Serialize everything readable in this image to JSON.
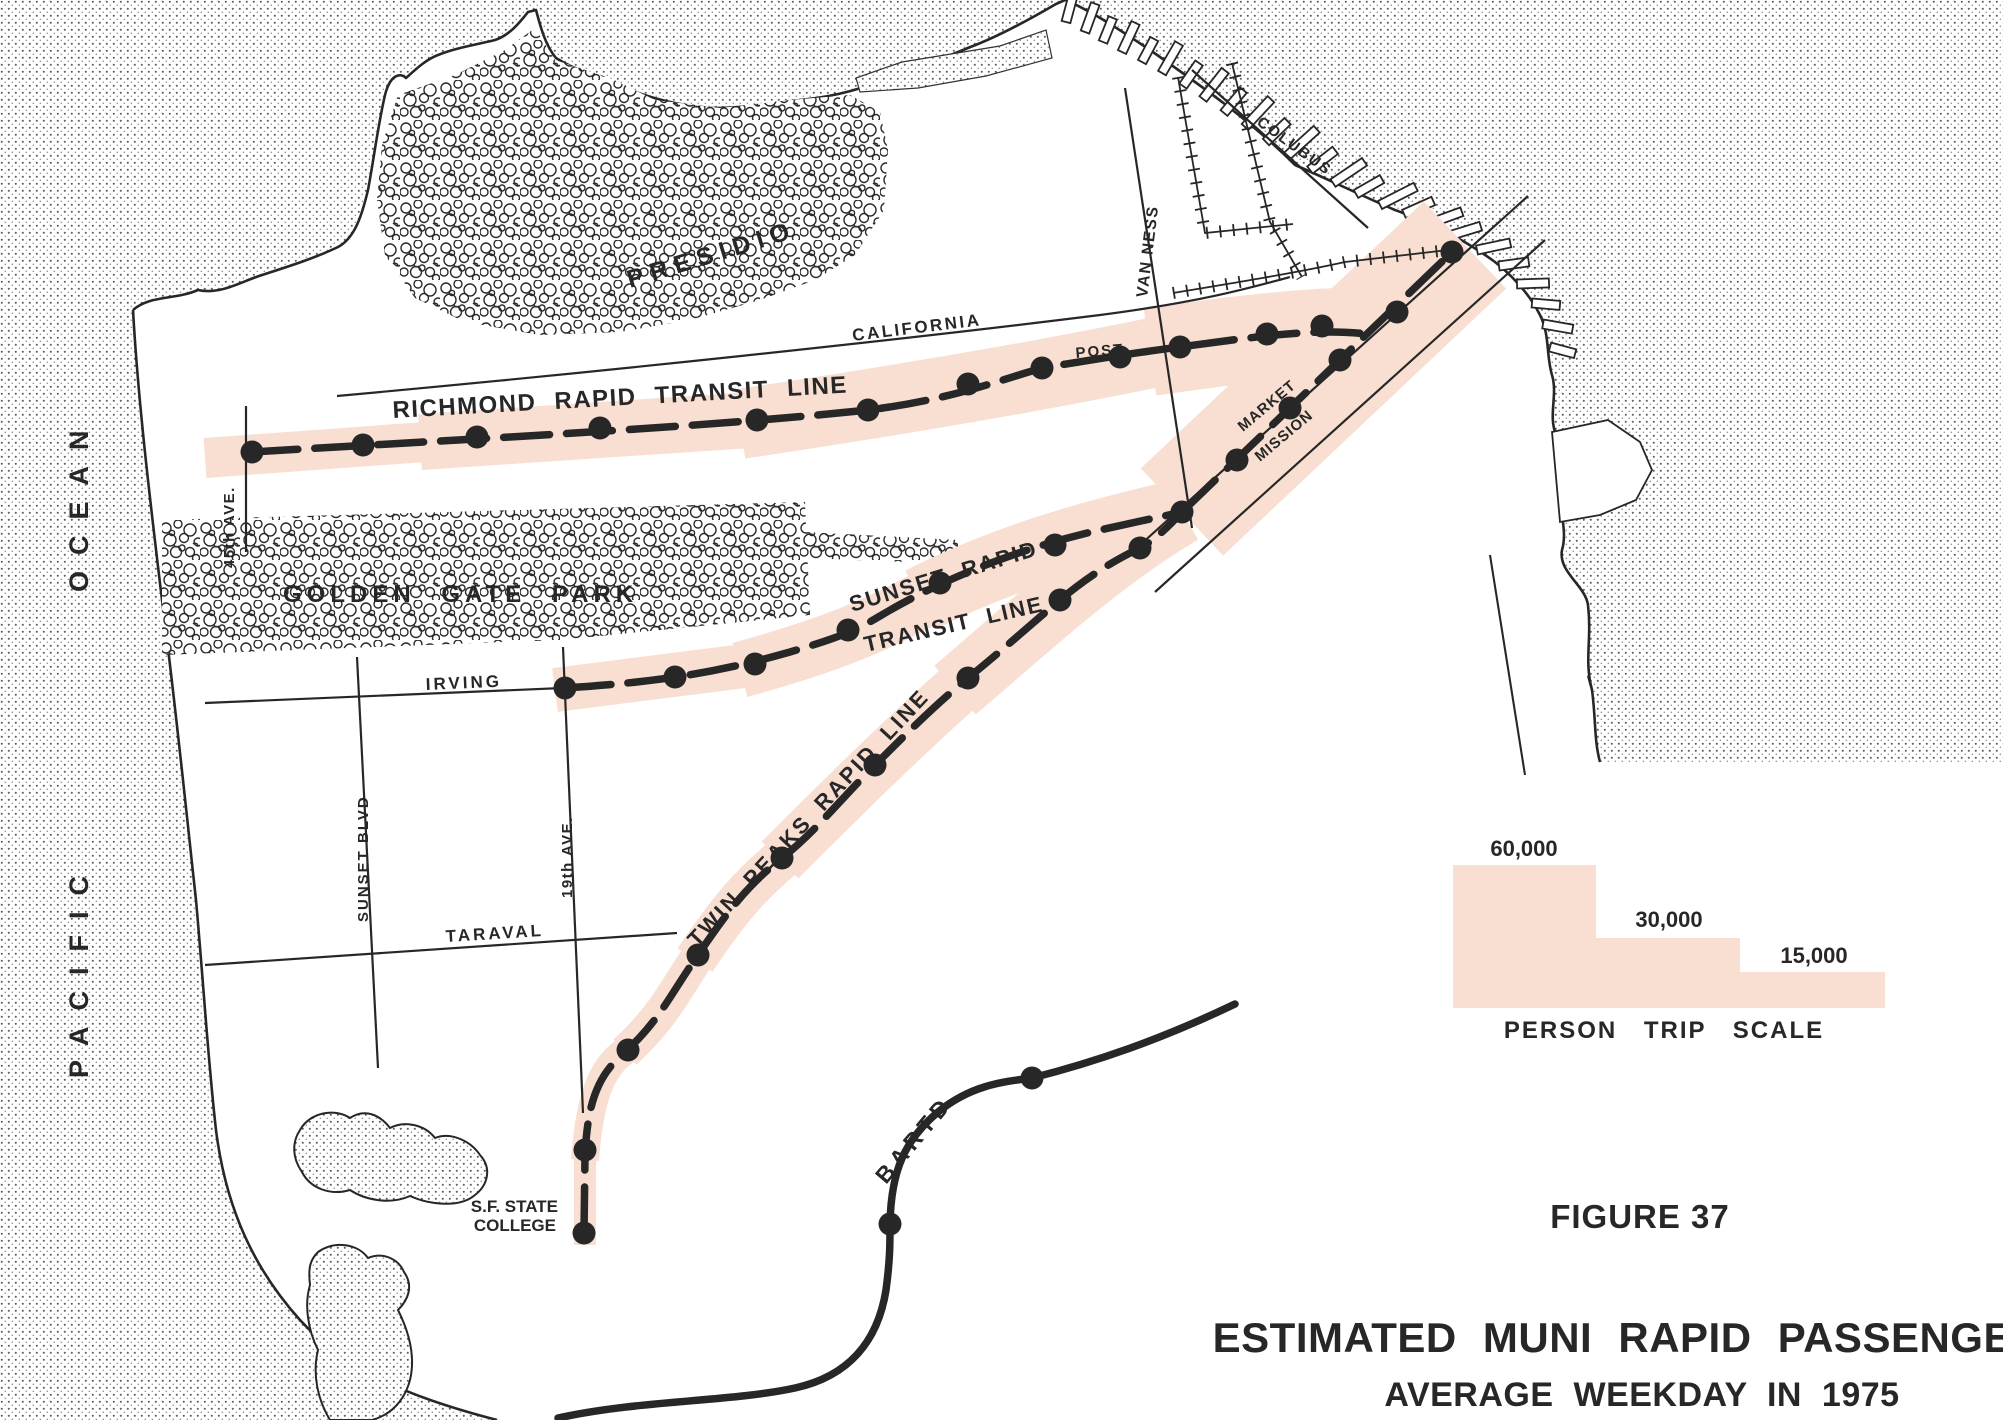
{
  "figure": {
    "number": "FIGURE 37",
    "title": "ESTIMATED MUNI RAPID PASSENGERS",
    "subtitle": "AVERAGE WEEKDAY IN 1975"
  },
  "legend": {
    "title": "PERSON TRIP SCALE",
    "steps": [
      {
        "label": "60,000",
        "value": 60000
      },
      {
        "label": "30,000",
        "value": 30000
      },
      {
        "label": "15,000",
        "value": 15000
      }
    ]
  },
  "ocean": {
    "word1": "PACIFIC",
    "word2": "OCEAN"
  },
  "places": {
    "presidio": "PRESIDIO",
    "golden_gate_park": "GOLDEN GATE PARK",
    "sf_state_line1": "S.F. STATE",
    "sf_state_line2": "COLLEGE"
  },
  "streets": {
    "california": "CALIFORNIA",
    "post": "POST",
    "van_ness": "VAN NESS",
    "columbus": "COLUBUS",
    "market": "MARKET",
    "mission": "MISSION",
    "irving": "IRVING",
    "taraval": "TARAVAL",
    "sunset_blvd": "SUNSET BLVD",
    "ave19": "19th AVE.",
    "ave45": "45th AVE."
  },
  "lines": {
    "richmond": {
      "label": "RICHMOND RAPID TRANSIT LINE",
      "stations": [
        [
          252,
          452
        ],
        [
          363,
          445
        ],
        [
          477,
          437
        ],
        [
          600,
          428
        ],
        [
          757,
          420
        ],
        [
          868,
          410
        ],
        [
          968,
          384
        ],
        [
          1042,
          368
        ],
        [
          1120,
          357
        ],
        [
          1180,
          347
        ],
        [
          1267,
          334
        ],
        [
          1322,
          326
        ]
      ]
    },
    "sunset": {
      "label_line1": "SUNSET RAPID",
      "label_line2": "TRANSIT LINE",
      "stations": [
        [
          565,
          688
        ],
        [
          675,
          677
        ],
        [
          755,
          664
        ],
        [
          848,
          630
        ],
        [
          940,
          583
        ],
        [
          1055,
          545
        ]
      ]
    },
    "twin_peaks": {
      "label": "TWIN PEAKS RAPID LINE",
      "stations": [
        [
          584,
          1233
        ],
        [
          585,
          1150
        ],
        [
          628,
          1050
        ],
        [
          698,
          955
        ],
        [
          782,
          858
        ],
        [
          875,
          765
        ],
        [
          968,
          678
        ],
        [
          1060,
          600
        ],
        [
          1140,
          548
        ]
      ]
    },
    "market_trunk": {
      "stations": [
        [
          1182,
          512
        ],
        [
          1237,
          460
        ],
        [
          1290,
          408
        ],
        [
          1340,
          360
        ],
        [
          1397,
          312
        ],
        [
          1452,
          252
        ]
      ]
    },
    "bartd": {
      "label": "BARTD",
      "stations": [
        [
          890,
          1224
        ],
        [
          1032,
          1078
        ]
      ]
    }
  },
  "colors": {
    "band_pink": "#f8dfd2",
    "ink": "#272727"
  }
}
